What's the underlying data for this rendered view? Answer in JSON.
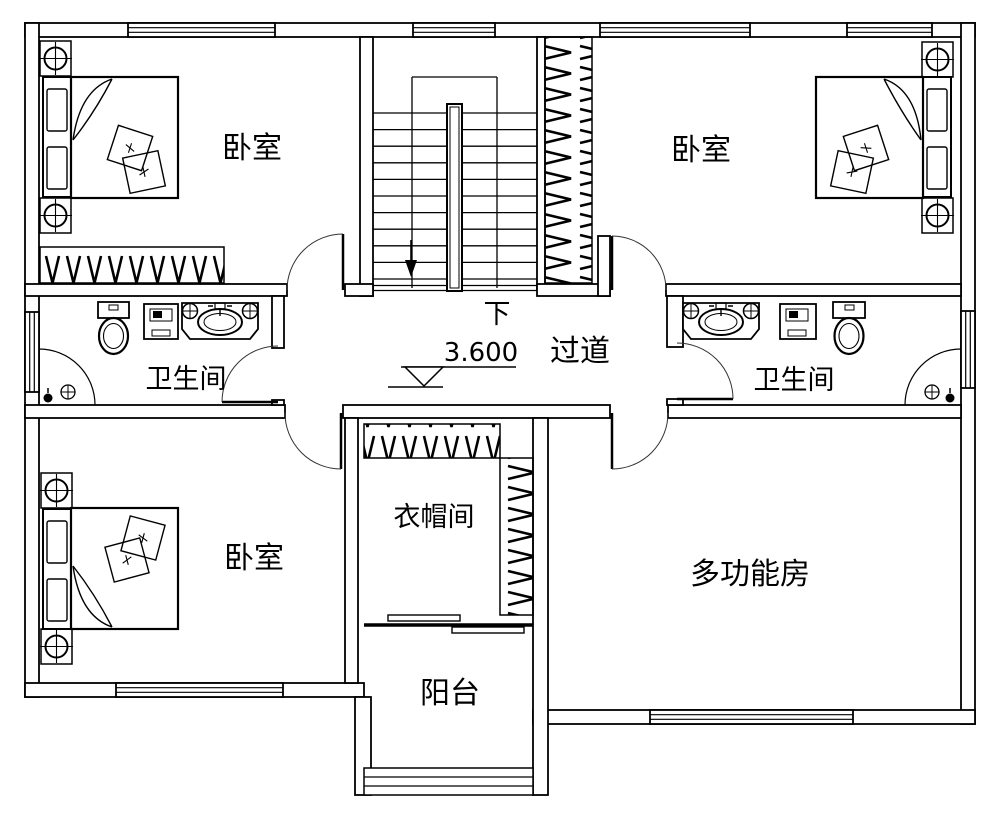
{
  "plan": {
    "background": "#ffffff",
    "line_color": "#000000",
    "rooms": [
      {
        "id": "bedroom-top-left",
        "label": "卧室"
      },
      {
        "id": "bedroom-top-right",
        "label": "卧室"
      },
      {
        "id": "bedroom-bottom-left",
        "label": "卧室"
      },
      {
        "id": "bathroom-left",
        "label": "卫生间"
      },
      {
        "id": "bathroom-right",
        "label": "卫生间"
      },
      {
        "id": "corridor",
        "label": "过道"
      },
      {
        "id": "cloakroom",
        "label": "衣帽间"
      },
      {
        "id": "balcony",
        "label": "阳台"
      },
      {
        "id": "multi-function-room",
        "label": "多功能房"
      }
    ],
    "stairs": {
      "down_label": "下"
    },
    "elevation_marker": {
      "value": "3.600"
    }
  }
}
